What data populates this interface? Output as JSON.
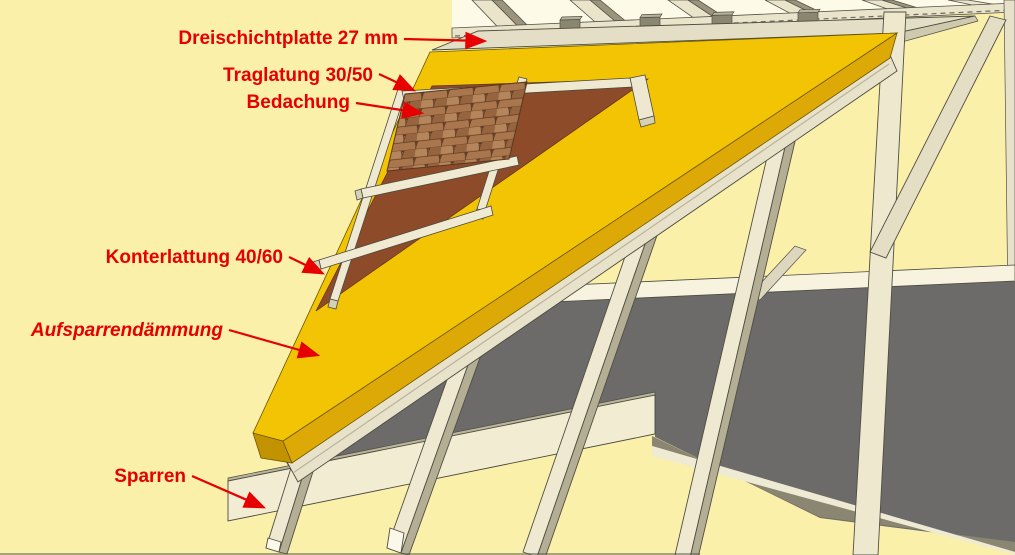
{
  "app": {
    "type": "3d-roof-construction-diagram",
    "subject": "Aufsparrendämmung (above-rafter insulation) build-up"
  },
  "labels": {
    "dreischichtplatte": "Dreischichtplatte 27 mm",
    "traglatung": "Traglatung 30/50",
    "bedachung": "Bedachung",
    "konterlattung": "Konterlattung 40/60",
    "aufsparrendaemmung": "Aufsparrendämmung",
    "sparren": "Sparren"
  },
  "colors": {
    "background": "#FAF0A9",
    "sky": "#FDFAE8",
    "insulation_top": "#F2C403",
    "insulation_edge": "#DDA906",
    "insulation_eave": "#C39200",
    "membrane_brown": "#8E4B29",
    "panel_cream": "#E3DEC5",
    "wood_light": "#EEE9D0",
    "wood_shadow": "#B4AE95",
    "floor_gray": "#6C6B69",
    "tile_brown": "#A9764E",
    "label_red": "#E60000"
  }
}
